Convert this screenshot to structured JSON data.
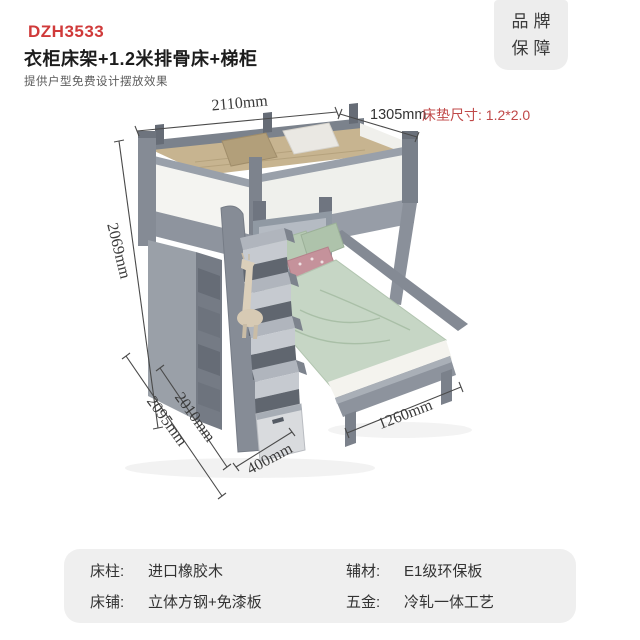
{
  "header": {
    "model": "DZH3533",
    "title": "衣柜床架+1.2米排骨床+梯柜",
    "subtitle": "提供户型免费设计摆放效果"
  },
  "badge": {
    "line1": "品牌",
    "line2": "保障"
  },
  "diagram": {
    "dimensions": {
      "width_top": "2110mm",
      "depth_top": "1305mm",
      "mattress_note": "床垫尺寸: 1.2*2.0",
      "height": "2069mm",
      "depth_total": "2095mm",
      "ladder_height": "2010mm",
      "ladder_depth": "400mm",
      "lower_bed_width": "1260mm"
    }
  },
  "specs": {
    "items": [
      {
        "label": "床柱:",
        "value": "进口橡胶木"
      },
      {
        "label": "辅材:",
        "value": "E1级环保板"
      },
      {
        "label": "床铺:",
        "value": "立体方钢+免漆板"
      },
      {
        "label": "五金:",
        "value": "冷轧一体工艺"
      }
    ]
  },
  "colors": {
    "accent_red": "#d03a3a",
    "note_red": "#c04848",
    "furniture_gray": "#8d939d",
    "bedding_green": "#c6d6c5",
    "mattress_tan": "#c7b490",
    "panel_bg": "#efefef"
  }
}
